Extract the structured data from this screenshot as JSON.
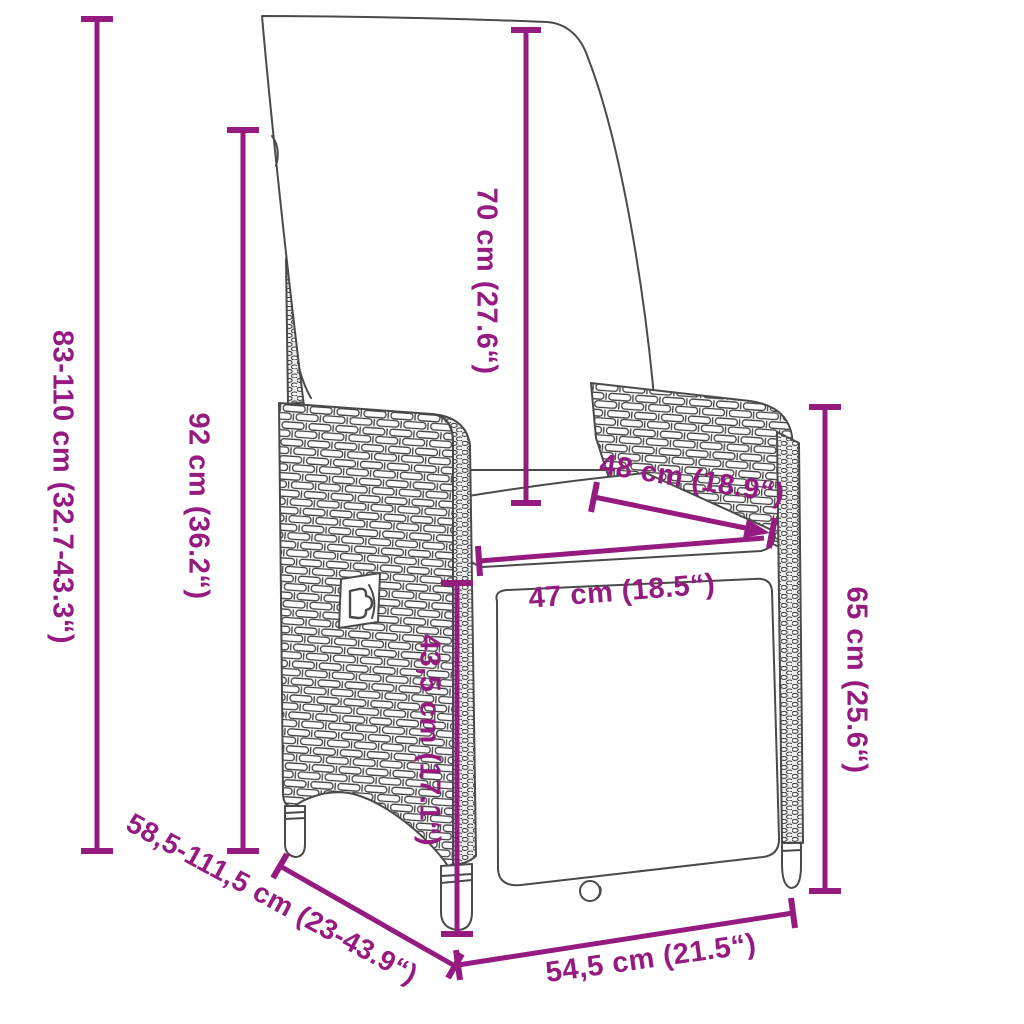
{
  "diagram": {
    "kind": "product-dimension-diagram",
    "subject": "reclining-rattan-garden-chair-with-cushions",
    "background": "#ffffff",
    "dimension_color": "#951B81",
    "outline_color": "#4a4a4a"
  },
  "dimensions": {
    "overall_height": {
      "label": "83-110 cm (32.7-43.3“)"
    },
    "backrest_height": {
      "label": "92 cm (36.2“)"
    },
    "back_cushion_height": {
      "label": "70 cm (27.6“)"
    },
    "seat_depth": {
      "label": "48 cm (18.9“)"
    },
    "seat_width": {
      "label": "47 cm (18.5“)"
    },
    "seat_height": {
      "label": "43,5 cm (17.1“)"
    },
    "armrest_height": {
      "label": "65 cm (25.6“)"
    },
    "depth_range": {
      "label": "58,5-111,5 cm (23-43.9“)"
    },
    "base_width": {
      "label": "54,5 cm (21.5“)"
    }
  }
}
